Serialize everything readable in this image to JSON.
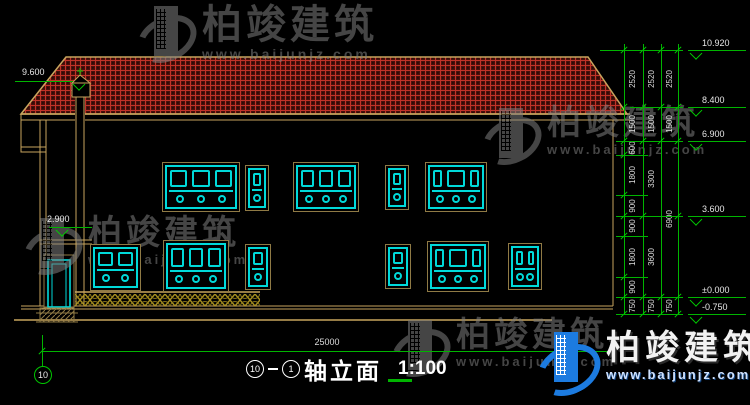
{
  "wm": {
    "brand": "柏竣建筑",
    "url": "www.baijunjz.com"
  },
  "colors": {
    "background": "#000000",
    "dim_green": "#00b400",
    "outline_tan": "#c8a55e",
    "window_cyan": "#00d9d9",
    "roof_red": "#c03228",
    "railing_gold": "#a8901f",
    "logo_blue": "#1c7be0"
  },
  "title": {
    "axis_start": "10",
    "axis_end": "1",
    "name": "轴立面",
    "scale": "1:100"
  },
  "bottom": {
    "span_dim": "25000",
    "axis_bubble": "10"
  },
  "drawing": {
    "chain_top_y": 44,
    "chain_bottom_y": 314,
    "chains": [
      {
        "line_x": 624,
        "text_x": 633,
        "boundaries": [
          50,
          107,
          141,
          155,
          195,
          216,
          236,
          277,
          297,
          314
        ],
        "values": [
          "2520",
          "1500",
          "600",
          "1800",
          "900",
          "900",
          "1800",
          "900",
          "750"
        ]
      },
      {
        "line_x": 643,
        "text_x": 652,
        "boundaries": [
          50,
          107,
          141,
          216,
          297,
          314
        ],
        "values": [
          "2520",
          "1500",
          "3300",
          "3600",
          "750"
        ]
      },
      {
        "line_x": 661,
        "text_x": 670,
        "boundaries": [
          50,
          107,
          141,
          297,
          314
        ],
        "values": [
          "2520",
          "1500",
          "6900",
          "750"
        ]
      },
      {
        "line_x": 678,
        "text_x": null,
        "boundaries": [
          50,
          107,
          141,
          216,
          297,
          314
        ],
        "values": []
      }
    ],
    "ext_lines": [
      {
        "y": 50,
        "x1": 600,
        "x2": 683
      },
      {
        "y": 107,
        "x1": 630,
        "x2": 683
      },
      {
        "y": 141,
        "x1": 616,
        "x2": 683
      },
      {
        "y": 216,
        "x1": 616,
        "x2": 683
      },
      {
        "y": 297,
        "x1": 616,
        "x2": 683
      },
      {
        "y": 314,
        "x1": 616,
        "x2": 683
      },
      {
        "y": 155,
        "x1": 616,
        "x2": 648
      },
      {
        "y": 195,
        "x1": 616,
        "x2": 648
      },
      {
        "y": 236,
        "x1": 616,
        "x2": 648
      },
      {
        "y": 277,
        "x1": 616,
        "x2": 648
      }
    ],
    "right_markers": [
      {
        "text": "10.920",
        "y": 50
      },
      {
        "text": "8.400",
        "y": 107
      },
      {
        "text": "6.900",
        "y": 141
      },
      {
        "text": "3.600",
        "y": 216
      },
      {
        "text": "±0.000",
        "y": 297
      },
      {
        "text": "-0.750",
        "y": 314
      }
    ],
    "right_marker_line": {
      "x1": 688,
      "x2": 746
    },
    "left_markers": [
      {
        "text": "9.600",
        "tx": 22,
        "ty": 68,
        "lx1": 15,
        "lx2": 73,
        "ly": 81,
        "tri_x": 79
      },
      {
        "text": "2.900",
        "tx": 47,
        "ty": 215,
        "lx1": 49,
        "lx2": 92,
        "ly": 227,
        "tri_x": 62
      }
    ],
    "windows": [
      {
        "x": 162,
        "y": 162,
        "w": 78,
        "h": 50,
        "t": "p3"
      },
      {
        "x": 245,
        "y": 165,
        "w": 24,
        "h": 46,
        "t": "p1"
      },
      {
        "x": 293,
        "y": 162,
        "w": 66,
        "h": 50,
        "t": "p3"
      },
      {
        "x": 385,
        "y": 165,
        "w": 24,
        "h": 45,
        "t": "p1"
      },
      {
        "x": 425,
        "y": 162,
        "w": 62,
        "h": 50,
        "t": "pc"
      },
      {
        "x": 90,
        "y": 244,
        "w": 51,
        "h": 47,
        "t": "p2"
      },
      {
        "x": 163,
        "y": 240,
        "w": 66,
        "h": 52,
        "t": "p3"
      },
      {
        "x": 245,
        "y": 244,
        "w": 26,
        "h": 46,
        "t": "p1"
      },
      {
        "x": 385,
        "y": 244,
        "w": 26,
        "h": 45,
        "t": "p1"
      },
      {
        "x": 427,
        "y": 241,
        "w": 62,
        "h": 51,
        "t": "pc"
      },
      {
        "x": 508,
        "y": 243,
        "w": 34,
        "h": 47,
        "t": "p2"
      }
    ]
  }
}
